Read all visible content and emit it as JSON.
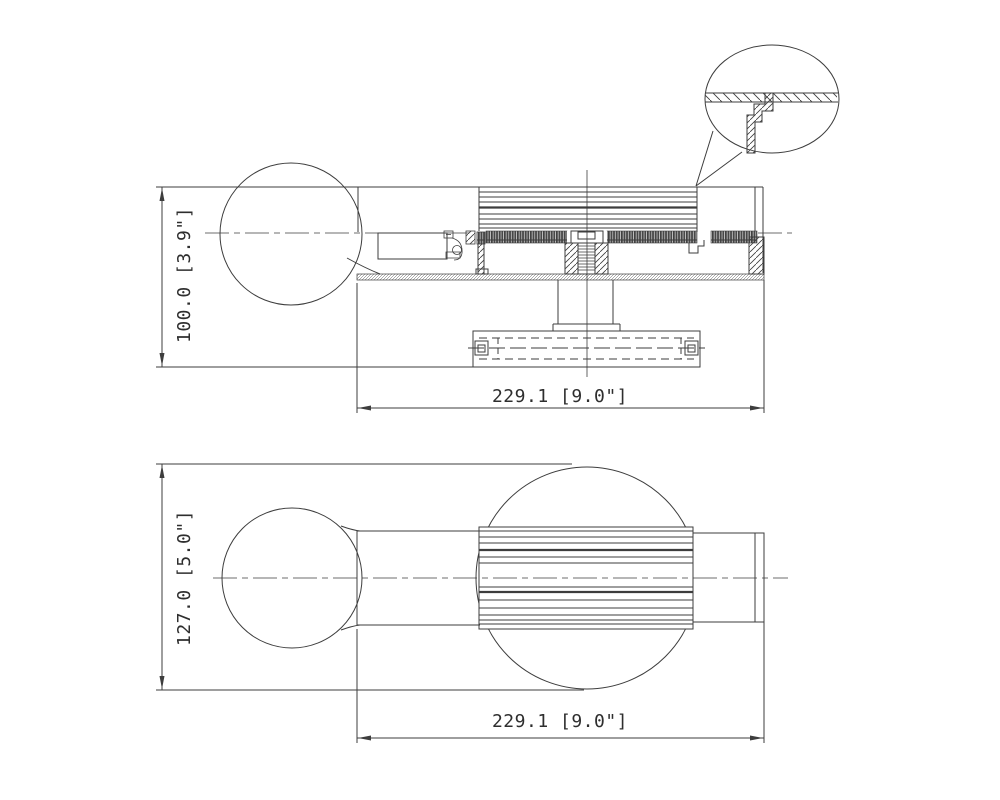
{
  "drawing": {
    "kind": "technical-dimension-drawing",
    "line_color": "#3d3d3d",
    "background": "#ffffff",
    "section_view": {
      "height_dim": "100.0 [3.9\"]",
      "width_dim": "229.1 [9.0\"]"
    },
    "plan_view": {
      "height_dim": "127.0 [5.0\"]",
      "width_dim": "229.1 [9.0\"]"
    }
  }
}
